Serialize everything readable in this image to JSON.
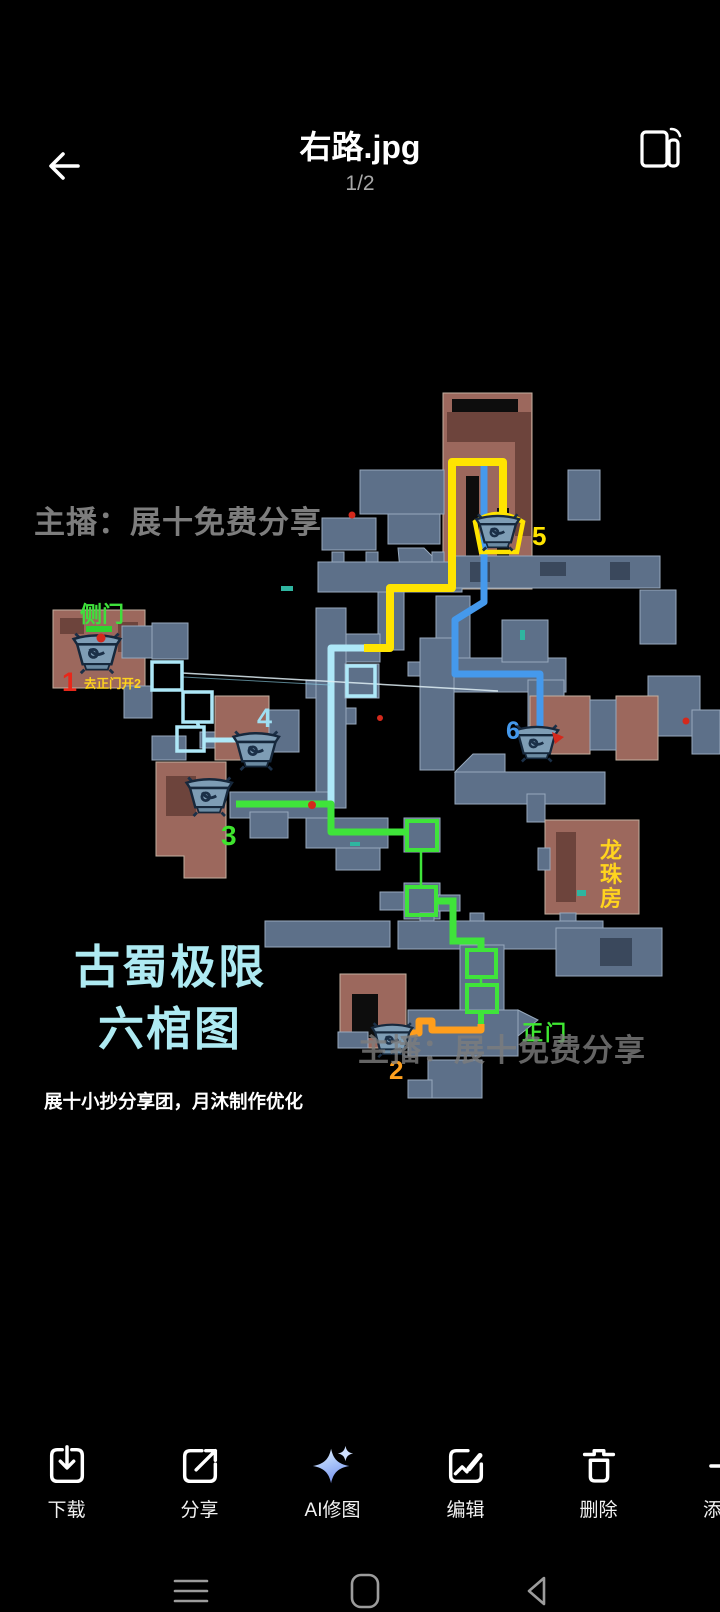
{
  "header": {
    "title": "右路.jpg",
    "page_indicator": "1/2"
  },
  "image": {
    "watermark_top": "主播：展十免费分享",
    "watermark_bottom": "主播：展十免费分享",
    "big_title_line1": "古蜀极限",
    "big_title_line2": "六棺图",
    "credit_line": "展十小抄分享团，月沐制作优化",
    "title_color": "#aeeaf2",
    "watermark_color": "#7d7d7d",
    "labels": {
      "side_door": {
        "text": "侧门",
        "color": "#3fe03c"
      },
      "marker1_note": {
        "text": "去正门开2",
        "color": "#ffd41e"
      },
      "main_door": {
        "text": "正门",
        "color": "#3fe832"
      },
      "dragon_room": {
        "chars": [
          "龙",
          "珠",
          "房"
        ],
        "color": "#ffd41e"
      }
    },
    "markers": [
      {
        "num": "1",
        "color": "#e8271a"
      },
      {
        "num": "2",
        "color": "#ffa01e"
      },
      {
        "num": "3",
        "color": "#3fe42e"
      },
      {
        "num": "4",
        "color": "#9fdff2"
      },
      {
        "num": "5",
        "color": "#ffe400"
      },
      {
        "num": "6",
        "color": "#4599ec"
      }
    ],
    "routes": {
      "yellow": "#ffe400",
      "blue": "#4599ec",
      "cyan": "#aee8f8",
      "green": "#3fe43a",
      "orange": "#ff9e1c"
    }
  },
  "toolbar": {
    "items": [
      {
        "label": "下载",
        "icon": "download-icon"
      },
      {
        "label": "分享",
        "icon": "share-icon"
      },
      {
        "label": "AI修图",
        "icon": "ai-sparkle-icon"
      },
      {
        "label": "编辑",
        "icon": "edit-image-icon"
      },
      {
        "label": "删除",
        "icon": "delete-icon"
      },
      {
        "label": "添加到",
        "icon": "add-to-icon"
      }
    ]
  },
  "navbar": {
    "icons": [
      "menu-icon",
      "home-icon",
      "back-icon"
    ]
  }
}
